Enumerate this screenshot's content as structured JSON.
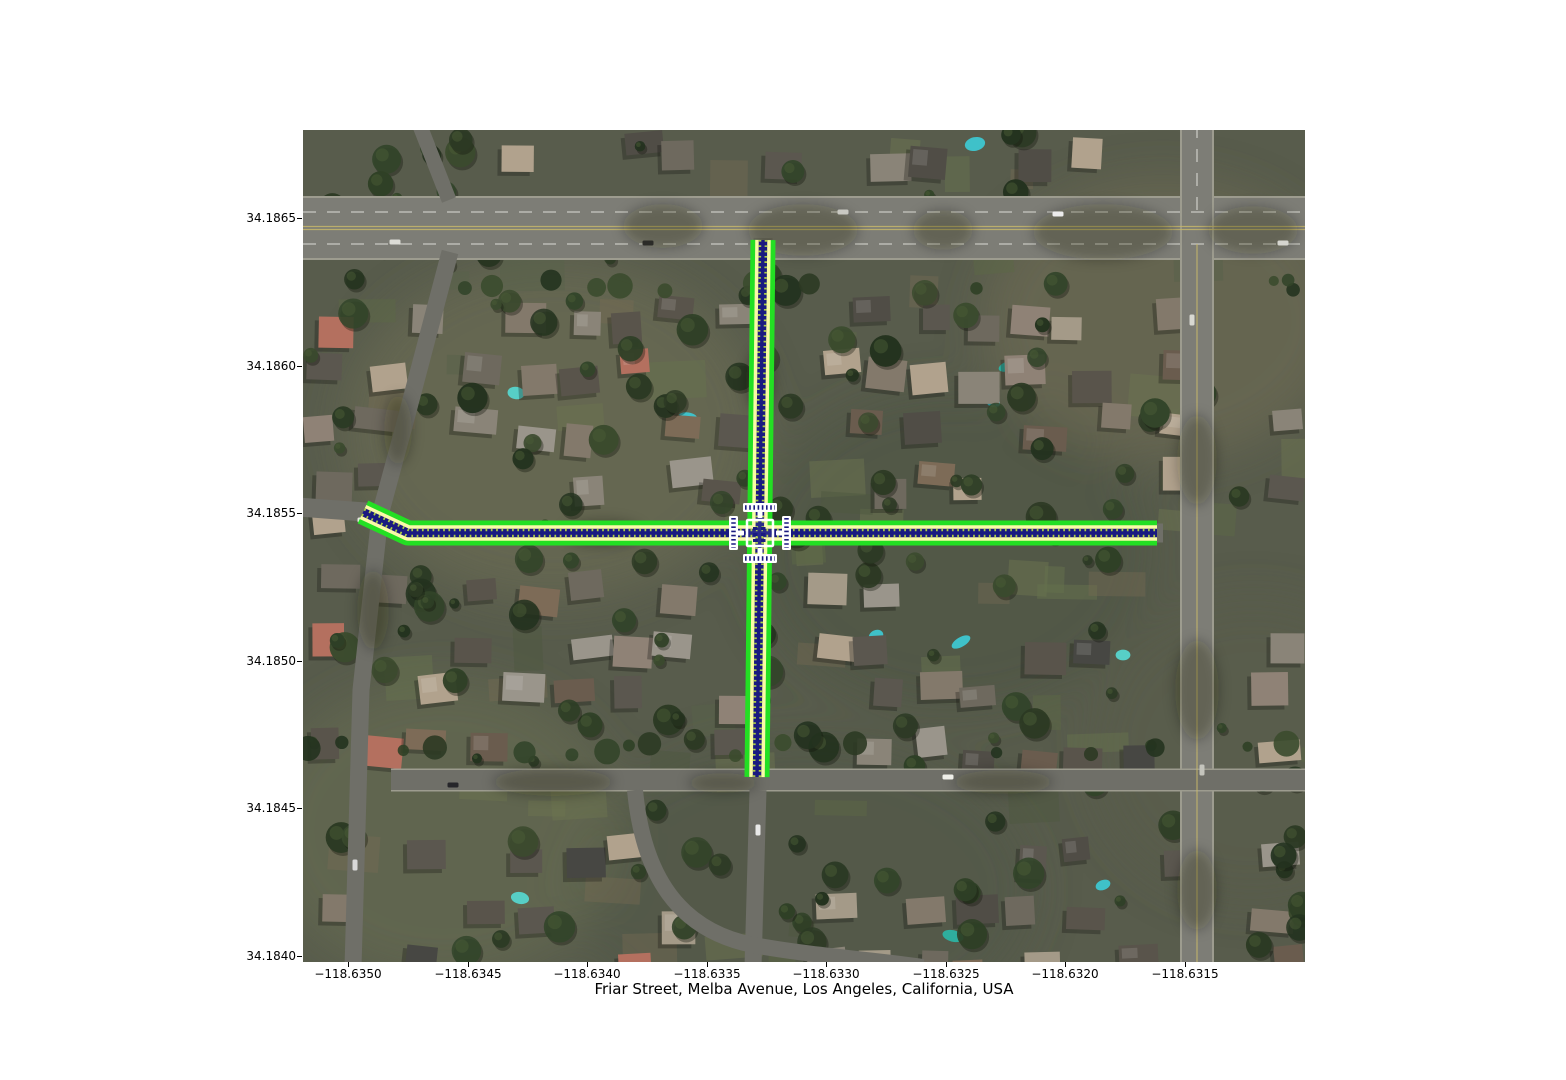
{
  "figure": {
    "title": "Friar Street, Melba Avenue, Los Angeles, California, USA",
    "x_axis": {
      "ticks": [
        "−118.6350",
        "−118.6345",
        "−118.6340",
        "−118.6335",
        "−118.6330",
        "−118.6325",
        "−118.6320",
        "−118.6315"
      ]
    },
    "y_axis": {
      "ticks": [
        "34.1865",
        "34.1860",
        "34.1855",
        "34.1850",
        "34.1845",
        "34.1840"
      ]
    }
  },
  "map": {
    "imagery": "satellite",
    "route_colors": {
      "edge": "#23df23",
      "lane": "#fafaa8",
      "center": "#1a1a80",
      "dash": "#aecf45",
      "marker": "#ffffff"
    }
  }
}
